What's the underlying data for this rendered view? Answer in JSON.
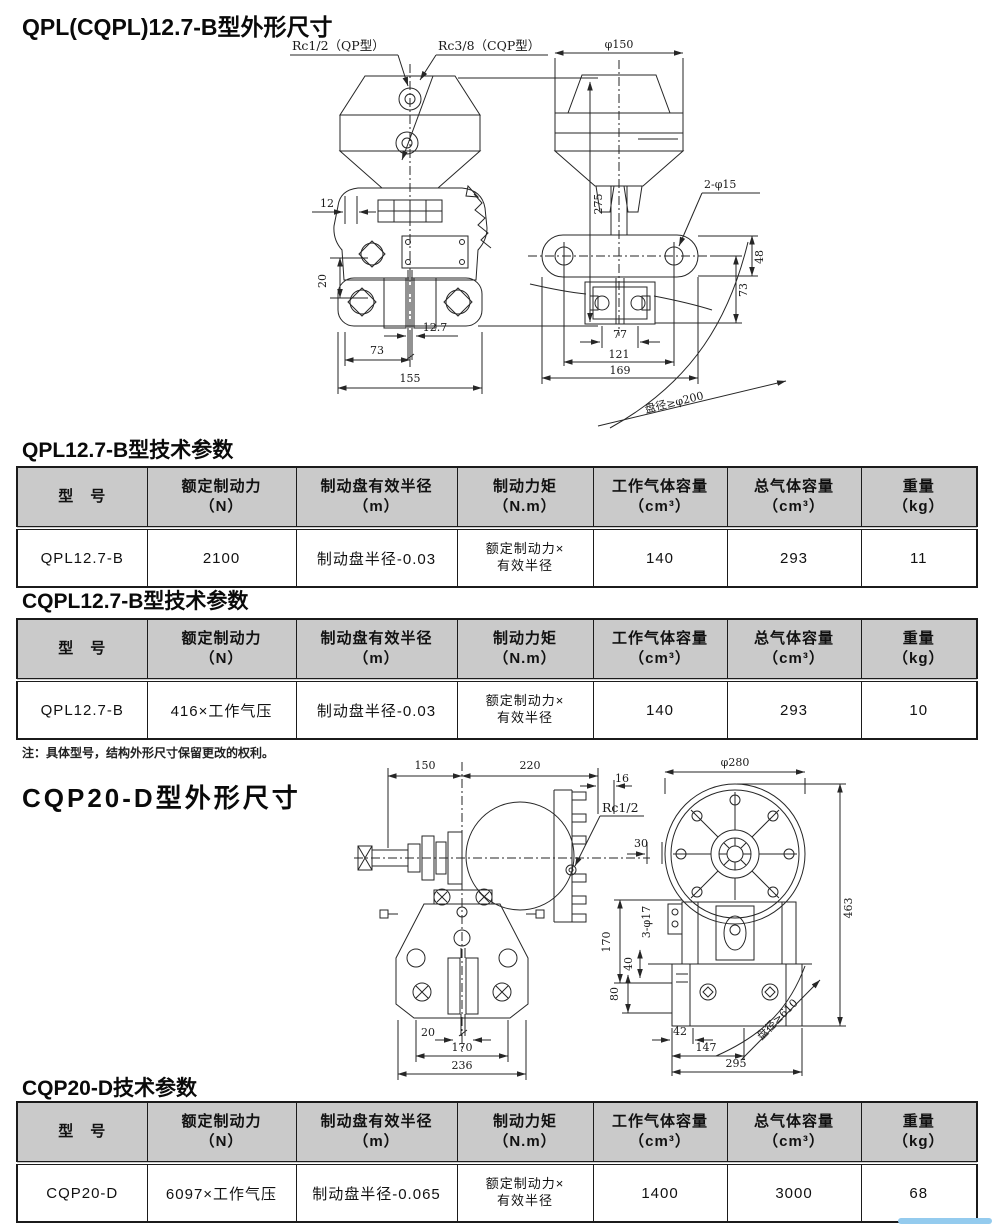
{
  "colors": {
    "header-bg": "#cacaca",
    "line": "#262626",
    "blue-bar": "#94cbee"
  },
  "sections": {
    "d1_title": "QPL(CQPL)12.7-B型外形尺寸",
    "t1_title": "QPL12.7-B型技术参数",
    "t2_title": "CQPL12.7-B型技术参数",
    "note": "注：具体型号，结构外形尺寸保留更改的权利。",
    "d2_title": "CQP20-D型外形尺寸",
    "t3_title": "CQP20-D技术参数"
  },
  "d1": {
    "rc12": "Rc1/2（QP型）",
    "rc38": "Rc3/8（CQP型）",
    "w12": "12",
    "h20": "20",
    "h275": "275",
    "w127": "12.7",
    "w73": "73",
    "w155": "155",
    "phi150": "φ150",
    "holes": "2-φ15",
    "h48": "48",
    "h73": "73",
    "w77": "77",
    "w121": "121",
    "w169": "169",
    "disc": "盘径≥φ200"
  },
  "d2": {
    "w150": "150",
    "w220": "220",
    "w16": "16",
    "rc12": "Rc1/2",
    "w20": "20",
    "w170": "170",
    "w236": "236",
    "phi280": "φ280",
    "h463": "463",
    "w30": "30",
    "holes": "3-φ17",
    "h170": "170",
    "h40": "40",
    "h80": "80",
    "w42": "42",
    "w147": "147",
    "w295": "295",
    "disc": "盘径≥610"
  },
  "tables": {
    "t1": {
      "headers": [
        {
          "t": "型　号",
          "u": ""
        },
        {
          "t": "额定制动力",
          "u": "（N）"
        },
        {
          "t": "制动盘有效半径",
          "u": "（m）"
        },
        {
          "t": "制动力矩",
          "u": "（N.m）"
        },
        {
          "t": "工作气体容量",
          "u": "（cm³）"
        },
        {
          "t": "总气体容量",
          "u": "（cm³）"
        },
        {
          "t": "重量",
          "u": "（kg）"
        }
      ],
      "row": {
        "model": "QPL12.7-B",
        "force": "2100",
        "radius": "制动盘半径-0.03",
        "torque1": "额定制动力×",
        "torque2": "有效半径",
        "work_vol": "140",
        "total_vol": "293",
        "weight": "11"
      }
    },
    "t2": {
      "headers": [
        {
          "t": "型　号",
          "u": ""
        },
        {
          "t": "额定制动力",
          "u": "（N）"
        },
        {
          "t": "制动盘有效半径",
          "u": "（m）"
        },
        {
          "t": "制动力矩",
          "u": "（N.m）"
        },
        {
          "t": "工作气体容量",
          "u": "（cm³）"
        },
        {
          "t": "总气体容量",
          "u": "（cm³）"
        },
        {
          "t": "重量",
          "u": "（kg）"
        }
      ],
      "row": {
        "model": "QPL12.7-B",
        "force": "416×工作气压",
        "radius": "制动盘半径-0.03",
        "torque1": "额定制动力×",
        "torque2": "有效半径",
        "work_vol": "140",
        "total_vol": "293",
        "weight": "10"
      }
    },
    "t3": {
      "headers": [
        {
          "t": "型　号",
          "u": ""
        },
        {
          "t": "额定制动力",
          "u": "（N）"
        },
        {
          "t": "制动盘有效半径",
          "u": "（m）"
        },
        {
          "t": "制动力矩",
          "u": "（N.m）"
        },
        {
          "t": "工作气体容量",
          "u": "（cm³）"
        },
        {
          "t": "总气体容量",
          "u": "（cm³）"
        },
        {
          "t": "重量",
          "u": "（kg）"
        }
      ],
      "row": {
        "model": "CQP20-D",
        "force": "6097×工作气压",
        "radius": "制动盘半径-0.065",
        "torque1": "额定制动力×",
        "torque2": "有效半径",
        "work_vol": "1400",
        "total_vol": "3000",
        "weight": "68"
      }
    }
  }
}
